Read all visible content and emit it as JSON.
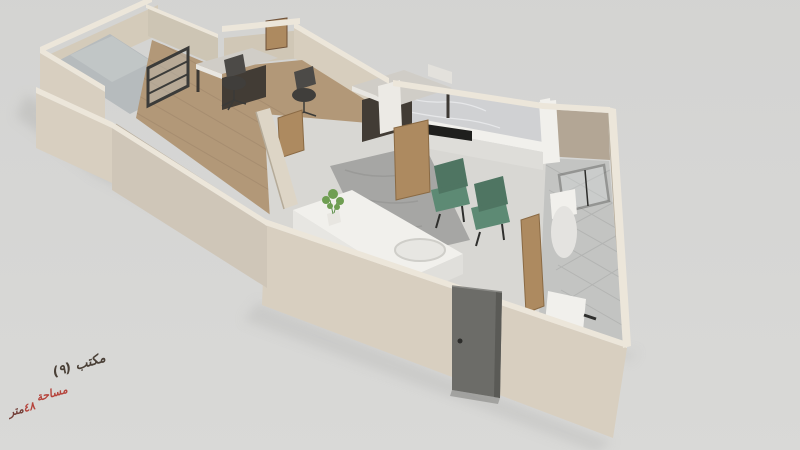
{
  "annotation": {
    "office_label": "مكتب (٩)",
    "area_label": "مساحة",
    "area_value": "٤٨",
    "area_unit": "متر",
    "label_color": "#4a4037",
    "accent_color": "#b5443c"
  },
  "scene": {
    "background_color": "#d5d5d3",
    "wall_color": "#d8cfc0",
    "wall_top_color": "#ece6da",
    "wall_shadow_color": "#b3a695",
    "office_floor_color": "#b29878",
    "utility_floor_color": "#b6bbbd",
    "living_floor_color": "#d8d7d3",
    "bathroom_floor_color": "#c3c4c2",
    "marble_color": "#d0d1d3",
    "rug_color": "#a6a6a4",
    "counter_color": "#f1f0ec",
    "cooktop_color": "#1f1f1d",
    "armchair_color": "#5d8a74",
    "wood_door_color": "#ad8a60",
    "entry_door_color": "#6c6c68",
    "desk_top_color": "#d0cdc7",
    "desk_base_color": "#423c35",
    "plant_color": "#6f9e52"
  }
}
